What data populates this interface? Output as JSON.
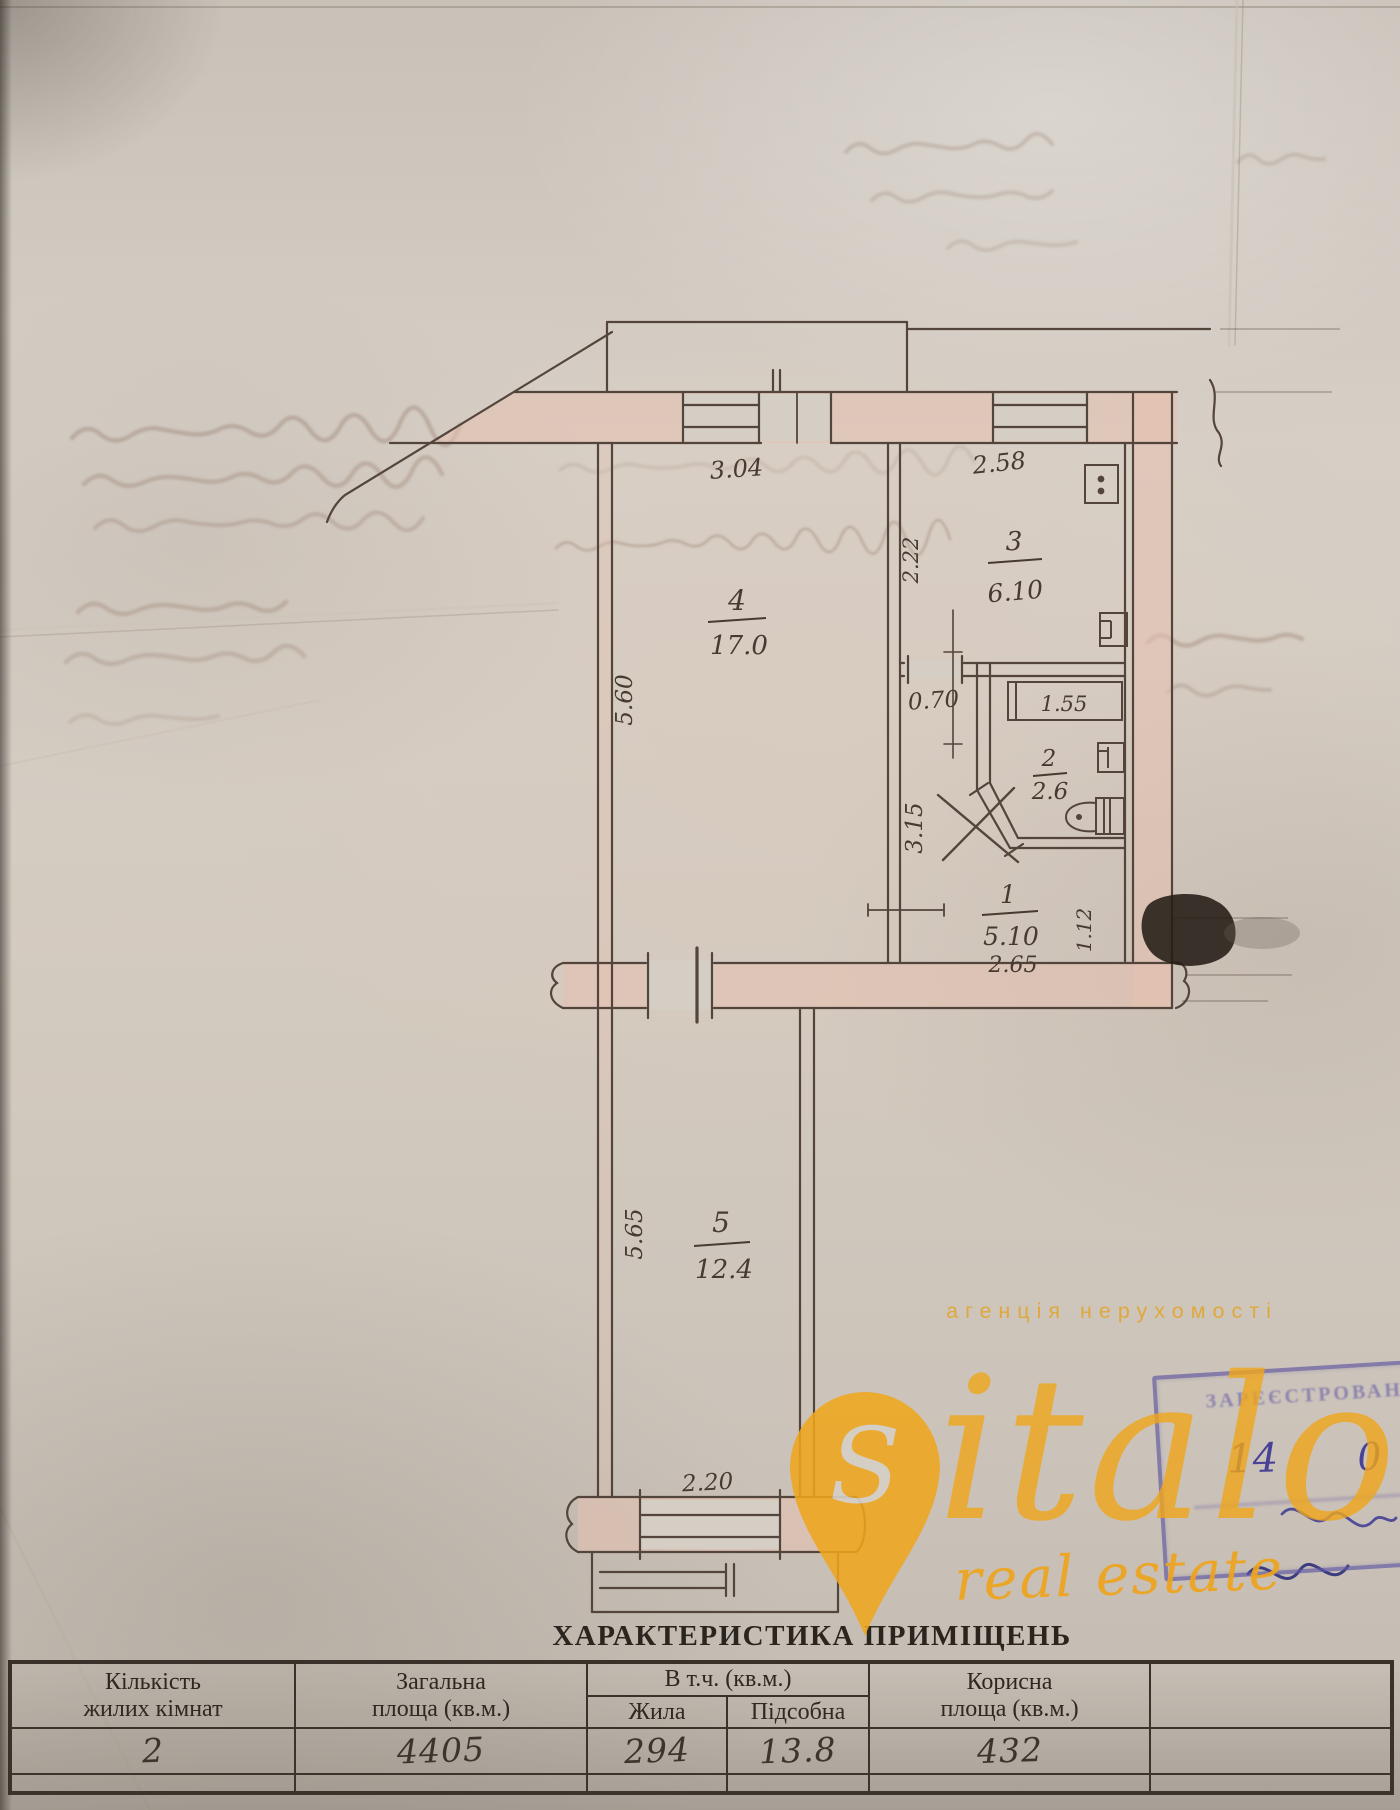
{
  "table": {
    "title": "ХАРАКТЕРИСТИКА ПРИМІЩЕНЬ",
    "headers": {
      "col1_line1": "Кількість",
      "col1_line2": "жилих кімнат",
      "col2_line1": "Загальна",
      "col2_line2": "площа (кв.м.)",
      "group": "В т.ч. (кв.м.)",
      "col3": "Жила",
      "col4": "Підсобна",
      "col5_line1": "Корисна",
      "col5_line2": "площа (кв.м.)"
    },
    "values": {
      "rooms": "2",
      "total": "4405",
      "living": "294",
      "auxiliary": "13.8",
      "useful": "432"
    }
  },
  "plan": {
    "rooms": [
      {
        "number": "4",
        "area": "17.0"
      },
      {
        "number": "3",
        "area": "6.10"
      },
      {
        "number": "2",
        "area": "2.6"
      },
      {
        "number": "1",
        "area": "5.10"
      },
      {
        "number": "5",
        "area": "12.4"
      }
    ],
    "dims": {
      "d304": "3.04",
      "d258": "2.58",
      "d560": "5.60",
      "d222": "2.22",
      "d070": "0.70",
      "d155": "1.55",
      "d315": "3.15",
      "d265": "2.65",
      "d112": "1.12",
      "d565": "5.65",
      "d220": "2.20"
    }
  },
  "stamp": {
    "line1": "ЗАРЕЄСТРОВАНО",
    "day": "14",
    "extra": "0"
  },
  "watermark": {
    "agency": "агенція нерухомості",
    "brand_initial": "S",
    "brand_rest": "italo",
    "tagline": "real estate"
  },
  "colors": {
    "ink": "#53443c",
    "wall_fill": "#e5c1b0",
    "watermark_gold": "#efa51c",
    "stamp_purple": "#6a5fae",
    "paper": "#d2cbc2"
  }
}
